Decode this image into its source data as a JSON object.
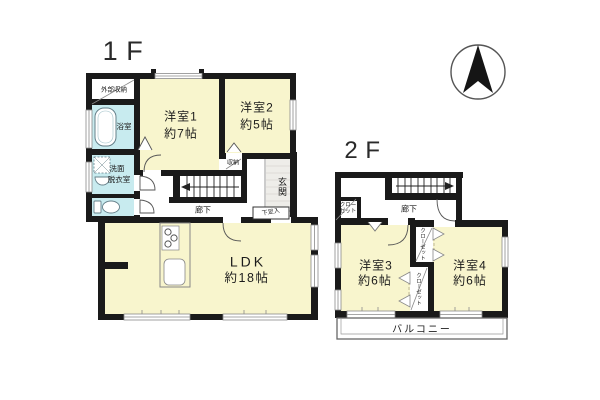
{
  "floor1": {
    "label": "1F",
    "rooms": {
      "western1": {
        "name": "洋室1",
        "size": "約7帖"
      },
      "western2": {
        "name": "洋室2",
        "size": "約5帖"
      },
      "ldk": {
        "name": "LDK",
        "size": "約18帖"
      },
      "bathroom": "浴室",
      "washroom_line1": "洗面",
      "washroom_line2": "脱衣室",
      "exterior_storage": "外部収納",
      "storage": "収納",
      "entrance": "玄関",
      "shoe_cabinet": "下足入",
      "hallway": "廊下"
    }
  },
  "floor2": {
    "label": "2F",
    "rooms": {
      "western3": {
        "name": "洋室3",
        "size": "約6帖"
      },
      "western4": {
        "name": "洋室4",
        "size": "約6帖"
      },
      "hallway": "廊下",
      "closet_hall": "クローゼット",
      "closet_upper": "クローゼット",
      "closet_lower": "クローゼット",
      "balcony": "バルコニー"
    }
  },
  "colors": {
    "room_yellow": "#f8f5cd",
    "wet_blue": "#c8ebef",
    "wall_black": "#1a1a1a",
    "entrance_gray": "#eeede9"
  }
}
